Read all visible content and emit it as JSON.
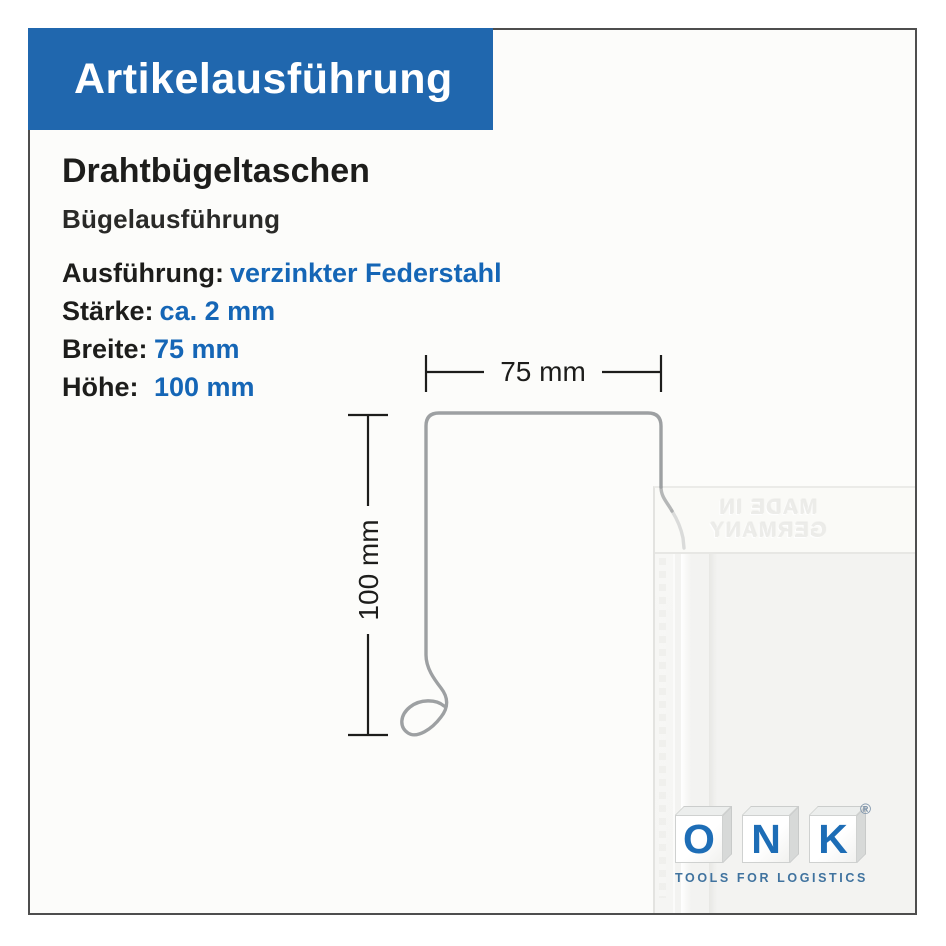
{
  "header": {
    "title": "Artikelausführung"
  },
  "product": {
    "title": "Drahtbügeltaschen",
    "subtitle": "Bügelausführung"
  },
  "specs": [
    {
      "label": "Ausführung:",
      "value": "verzinkter Federstahl"
    },
    {
      "label": "Stärke:",
      "value": "ca. 2 mm"
    },
    {
      "label": "Breite:",
      "value": "75 mm"
    },
    {
      "label": "Höhe:",
      "value": "100 mm"
    }
  ],
  "diagram": {
    "width_label": "75 mm",
    "height_label": "100 mm",
    "emboss_line1": "MADE IN",
    "emboss_line2": "GERMANY"
  },
  "logo": {
    "letter1": "O",
    "letter2": "N",
    "letter3": "K",
    "registered": "®",
    "tagline": "TOOLS FOR LOGISTICS"
  },
  "colors": {
    "accent_blue": "#2067ae",
    "value_blue": "#1566b6",
    "logo_blue": "#1d6db6",
    "tagline_blue": "#40739f",
    "text_dark": "#1d1d1b",
    "frame_gray": "#4e4e4e",
    "wire_gray": "#9da0a2"
  }
}
